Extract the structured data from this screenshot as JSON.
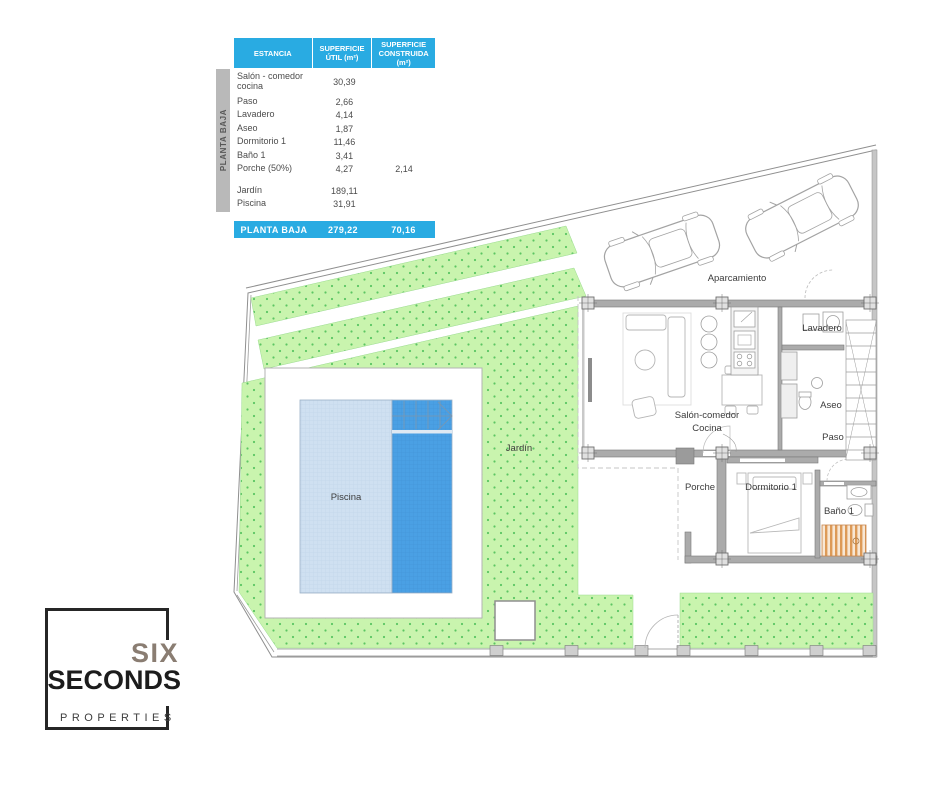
{
  "surface_table": {
    "side_label": "PLANTA BAJA",
    "columns": [
      "ESTANCIA",
      "SUPERFICIE ÚTIL (m²)",
      "SUPERFICIE CONSTRUIDA (m²)"
    ],
    "rows": [
      {
        "name": "Salón - comedor cocina",
        "util": "30,39",
        "built": ""
      },
      {
        "name": "Paso",
        "util": "2,66",
        "built": ""
      },
      {
        "name": "Lavadero",
        "util": "4,14",
        "built": ""
      },
      {
        "name": "Aseo",
        "util": "1,87",
        "built": ""
      },
      {
        "name": "Dormitorio 1",
        "util": "11,46",
        "built": ""
      },
      {
        "name": "Baño 1",
        "util": "3,41",
        "built": ""
      },
      {
        "name": "Porche (50%)",
        "util": "4,27",
        "built": "2,14"
      },
      {
        "name": "Jardín",
        "util": "189,11",
        "built": ""
      },
      {
        "name": "Piscina",
        "util": "31,91",
        "built": ""
      }
    ],
    "total": {
      "label": "PLANTA BAJA",
      "util": "279,22",
      "built": "70,16"
    }
  },
  "plan": {
    "labels": {
      "aparcamiento": "Aparcamiento",
      "lavadero": "Lavadero",
      "aseo": "Aseo",
      "paso": "Paso",
      "salon_line1": "Salón-comedor",
      "salon_line2": "Cocina",
      "jardin": "Jardín",
      "piscina": "Piscina",
      "porche": "Porche",
      "dormitorio": "Dormitorio 1",
      "bano": "Baño 1"
    }
  },
  "logo": {
    "line1": "SIX",
    "line2": "SECONDS",
    "line3": "PROPERTIES"
  },
  "colors": {
    "accent_blue": "#29abe2",
    "garden_green": "#c9f4ae",
    "garden_dot": "#5bc563",
    "pool_light": "#cfe0f1",
    "pool_dark": "#4aa0e4",
    "wall_gray": "#ababab",
    "sidebar_gray": "#b9b9b9",
    "shower_orange": "#dd9a57",
    "logo_taupe": "#8a7d72"
  }
}
